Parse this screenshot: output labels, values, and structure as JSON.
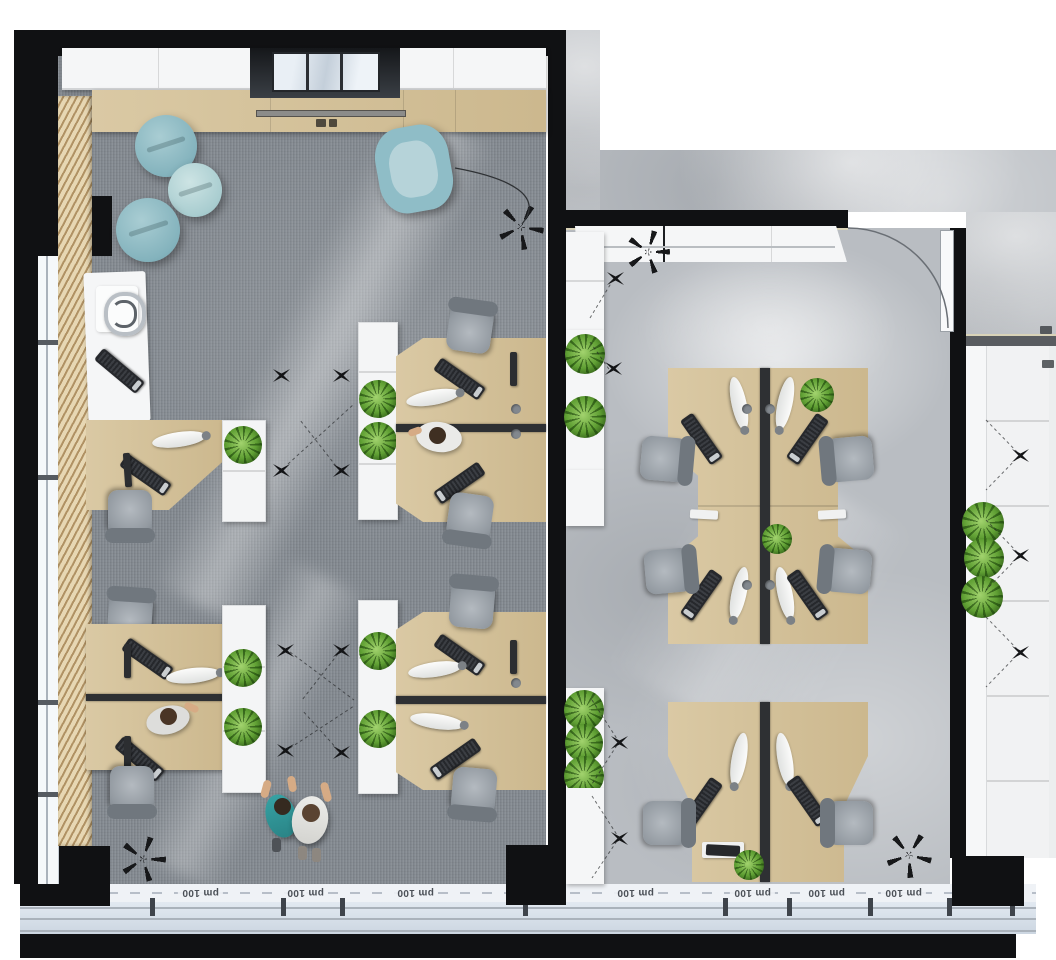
{
  "scene": {
    "kind": "top-down 3D rendered office floor plan",
    "rooms": {
      "left_office": {
        "floor": "gray carpet",
        "lounge_poufs": 3,
        "lounge_armchairs": 1,
        "workstations": 7,
        "reception_desks": 1,
        "skylights": 1
      },
      "right_office": {
        "floor": "polished concrete",
        "workstations": 6,
        "doors": 1,
        "wall_units": 1
      },
      "corridor": {
        "floor": "light screed",
        "planter_cabinets": 3
      }
    },
    "people": {
      "standing": 2,
      "seated": 2
    },
    "plants_total": 18,
    "ceiling_spotlights": 15,
    "vacant_chair_frames": 4
  },
  "facade": {
    "module_labels": [
      "pm 100",
      "pm 100",
      "pm 100",
      "pm 100",
      "pm 100",
      "pm 100",
      "pm 100"
    ],
    "labels_rotated_180": true
  },
  "palette": {
    "wall_black": "#101113",
    "carpet_gray": "#858b92",
    "concrete_gray": "#b9bdc2",
    "wood_light": "#d5c29c",
    "wood_slats": "#c3a577",
    "white_furniture": "#f5f6f7",
    "teal_seating": "#8fbdc7",
    "plant_green": "#5f9f33",
    "chair_gray": "#99a0a6",
    "keyboard_black": "#26282c",
    "glazing_blue": "#dfe7f0"
  }
}
